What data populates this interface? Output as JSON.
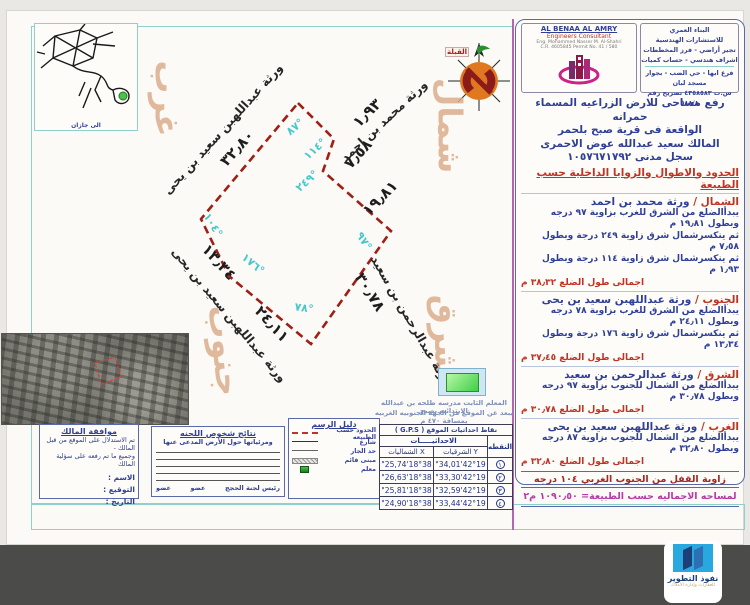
{
  "header": {
    "firm_en": {
      "name": "AL BENAA AL AMRY",
      "sub": "Engineers Consultant",
      "line3": "Eng. Mohammed Nasser M. Al-Shahri",
      "line4": "C.R. 4605845    Permit No. 41 / 580"
    },
    "firm_ar": {
      "l1": "البناء العمري",
      "l2": "للاستشارات الهندسية",
      "l3": "تجير أراضي - فرز المخططات",
      "l4": "اشراف هندسي - حساب كميات",
      "l5": "فرع ابها - حي الضب - بجوار مسجد لبان",
      "l6": "س.ت ٤٣٥٨٥٨٣ تصريح رقم ٥٨٨/٨"
    }
  },
  "intro": {
    "l1": "رفع مساحى للارض الزراعيه المسماء حمرانه",
    "l2": "الواقعة فى قرية صبح بلحمر",
    "l3": "المالك سعيد عبدالله عوض الاحمرى",
    "l4": "سجل مدنى    ١٠٥٧٦٧١٧٩٢"
  },
  "boundaries": {
    "title": "الحدود والاطوال والزوايا الداخلية حسب الطبيعة",
    "north": {
      "label": "الشمال /",
      "owner": "ورثة محمد بن احمد",
      "l1": "يبدأالضلع من الشرق للغرب بزاوية ٩٧ درجه وبطول ١٩٫٨١ م",
      "l2": "ثم ينكسرشمال شرق زاوية ٢٤٩ درجة وبطول ٧٫٥٨ م",
      "l3": "ثم ينكسرشمال شرق زاوية ١١٤ درجة وبطول ١٫٩٣ م",
      "total": "اجمالى طول الضلع ٣٨٫٣٢ م"
    },
    "south": {
      "label": "الجنوب /",
      "owner": "ورثة عبداللهبن سعيد بن يحى",
      "l1": "يبدأالضلع من الشرق للغرب بزاوية ٧٨ درجه",
      "l2": "وبطول ٢٤٫١١ م",
      "l3": "ثم ينكسرشمال شرق زاوية ١٧٦ درجة وبطول ١٣٫٣٤ م",
      "total": "اجمالى طول الضلع ٣٧٫٤٥ م"
    },
    "east": {
      "label": "الشرق /",
      "owner": "ورثة عبدالرحمن بن سعيد",
      "l1": "يبدأالضلع من الشمال للجنوب بزاوية ٩٧ درجه",
      "l2": "وبطول ٣٠٫٧٨ م",
      "total": "اجمالى طول الضلع ٣٠٫٧٨ م"
    },
    "west": {
      "label": "الغرب /",
      "owner": "ورثة عبداللهبن سعيد بن يحى",
      "l1": "يبدأالضلع من الشمال للجنوب بزاوية ٨٧ درجه",
      "l2": "وبطول ٣٢٫٨٠ م",
      "total": "اجمالى طول الضلع ٣٢٫٨٠ م"
    },
    "closing": "زاوية القفل من الجنوب الغربي  ١٠٤ درجه",
    "area": "لمساحه الاجماليه حسب الطبيعة=  ١٠٩٠٫٥٠ م٢"
  },
  "gps": {
    "title": "نقاط احداثيات الموقع ( G.P.S )",
    "point": "النقطه",
    "coords": "الاحداثيـــــات",
    "east_col": "Y الشرقيات",
    "north_col": "X الشمالیات",
    "rows": [
      {
        "n": "١",
        "e": "42°19'34,01\"",
        "w": "18°38'25,74\""
      },
      {
        "n": "٢",
        "e": "42°19'33,30\"",
        "w": "18°38'26,63\""
      },
      {
        "n": "٣",
        "e": "42°19'32,59\"",
        "w": "18°38'25,81\""
      },
      {
        "n": "٤",
        "e": "42°19'33,44\"",
        "w": "18°38'24,90\""
      }
    ]
  },
  "legend": {
    "title": "دليل الرسم",
    "i1": "الحدود حسب الطبيعه",
    "i2": "شارع",
    "i3": "حد الجار",
    "i4": "مبنى قائم",
    "i5": "معلم"
  },
  "committee": {
    "title": "نتائج شخوص اللجنه",
    "subtitle": "ومرئياتها حول الأرض المدعى عنها",
    "m1": "عضو",
    "m2": "عضو",
    "head": "رئيس لجنة الحجج"
  },
  "approval": {
    "title": "موافقة المالك",
    "l1": "تم الاستدلال على الموقع من قبل المالك -",
    "l2": "وجميع ما تم رفعه على سؤلية المالك",
    "f1": "الاسم :",
    "f2": "التوقيع :",
    "f3": "التاريخ :"
  },
  "landmark": {
    "l1": "المعلم الثابت مدرسه طلحه بن عبدالله الابتدائيه بصبح",
    "l2": "يبعد عن الموقع من الجهه الجنوبيه الغربيه بمسافة ٤٧٠ م"
  },
  "plot": {
    "dir_north": "شمال",
    "dir_west": "غرب",
    "dir_east": "شرق",
    "dir_south": "جنوب",
    "owner_ne": "ورثة محمد بن احمد",
    "owner_nw": "ورثة عبداللهبن سعيد بن يحى",
    "owner_se": "ورثة عبدالرحمن بن سعيد",
    "owner_sw": "ورثة عبداللهبن سعيد بن يحى",
    "len_nw": "٣٢٫٨٠",
    "len_ne1": "١٫٩٣",
    "len_ne2": "٧٫٥٨",
    "len_ne3": "١٩٫٨١",
    "len_se": "٣٠٫٧٨",
    "len_sw1": "٢٤٫١١",
    "len_sw2": "١٣٫٣٤",
    "ang_n": "٨٧°",
    "ang_ne1": "١١٤°",
    "ang_ne2": "٢٤٩°",
    "ang_e": "٩٧°",
    "ang_s": "٧٨°",
    "ang_sw": "١٧٦°",
    "ang_w": "١٠٤°"
  },
  "map": {
    "caption": "الى جازان"
  },
  "compass": {
    "label": "القبلة"
  },
  "watermark": {
    "title": "نفوذ التطوير",
    "subtitle": "للعقارات وإدارة الأملاك"
  },
  "colors": {
    "boundary_red": "#9e1f15",
    "angle_cyan": "#49c8cc",
    "panel_navy": "#2f3f97",
    "heading_red": "#c03425",
    "area_magenta": "#b83aa8",
    "teal_border": "#8fd0cc",
    "direction_beige": "#dcae8e",
    "band_gray": "#4b4b49",
    "logo_cyan": "#29a8df"
  }
}
